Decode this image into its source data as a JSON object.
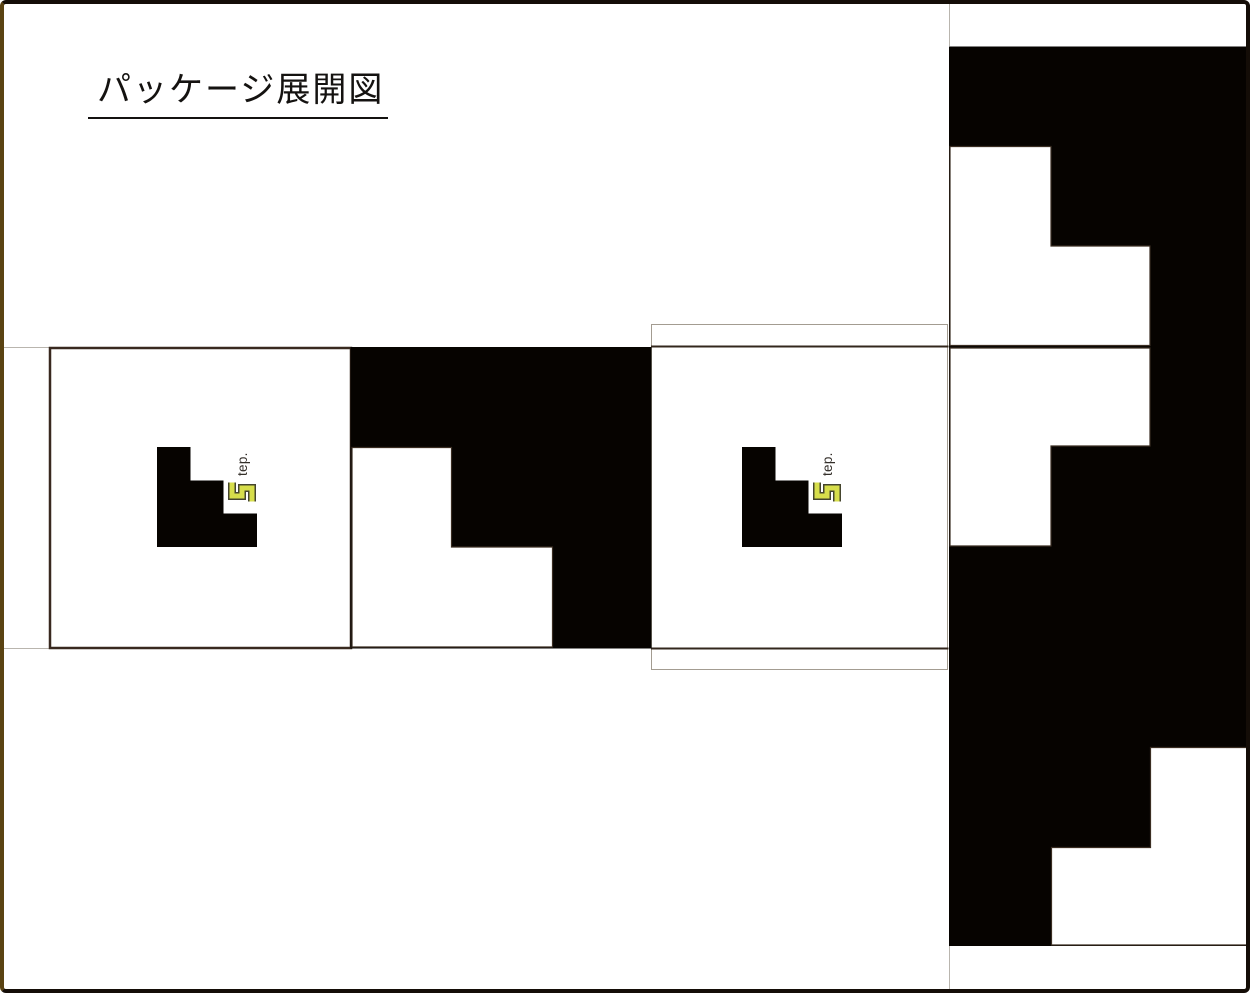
{
  "page": {
    "title": "パッケージ展開図",
    "background": "#ffffff",
    "border_color": "#140d07"
  },
  "logo": {
    "s_letter": "S",
    "text": "tep.",
    "s_fill": "#d7de4b",
    "s_outline": "#45452e",
    "text_color": "#332e29"
  },
  "colors": {
    "die_black": "#060300",
    "face_border": "#38291f",
    "fold_line": "#33271d",
    "crease_line": "#b9b5ae",
    "flap_outline": "#a39c91"
  }
}
